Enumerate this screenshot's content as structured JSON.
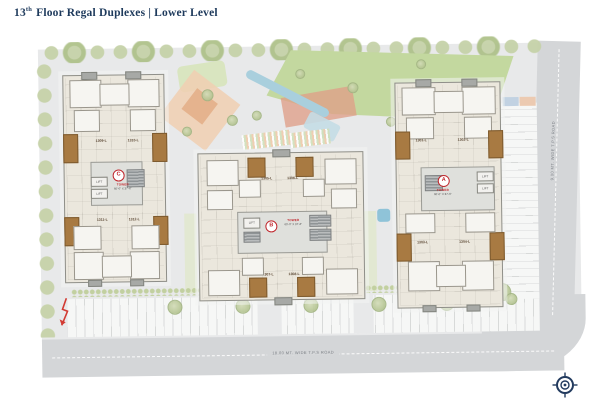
{
  "title": {
    "num": "13",
    "sup": "th",
    "rest": "Floor Regal Duplexes |  Lower Level"
  },
  "roads": {
    "bottom_label": "18.00 MT. WIDE T.P.S ROAD",
    "right_label": "9.00 MT. WIDE T.P.S ROAD"
  },
  "towers": [
    {
      "letter": "A",
      "tower_label": "TOWER",
      "dims": "60'-0\" X 37'-6\"",
      "lift": "LIFT",
      "units": [
        "1301-L",
        "1302-L",
        "1303-L",
        "1304-L"
      ]
    },
    {
      "letter": "B",
      "tower_label": "TOWER",
      "dims": "60'-0\" X 37'-6\"",
      "lift": "LIFT",
      "units": [
        "1305-L",
        "1306-L",
        "1307-L",
        "1308-L"
      ]
    },
    {
      "letter": "C",
      "tower_label": "TOWER",
      "dims": "60'-0\" X 37'-6\"",
      "lift": "LIFT",
      "units": [
        "1309-L",
        "1310-L",
        "1311-L",
        "1312-L"
      ]
    }
  ],
  "colors": {
    "title_navy": "#1e3a5c",
    "marker_red": "#c0272d",
    "balcony_brown": "#a87a42",
    "lawn_green": "#c3d89f",
    "water_blue": "#a9cfdd",
    "site_gray": "#e8e9ea",
    "road_gray": "#d4d6d8",
    "tree_sage": "#c6d2a9"
  }
}
